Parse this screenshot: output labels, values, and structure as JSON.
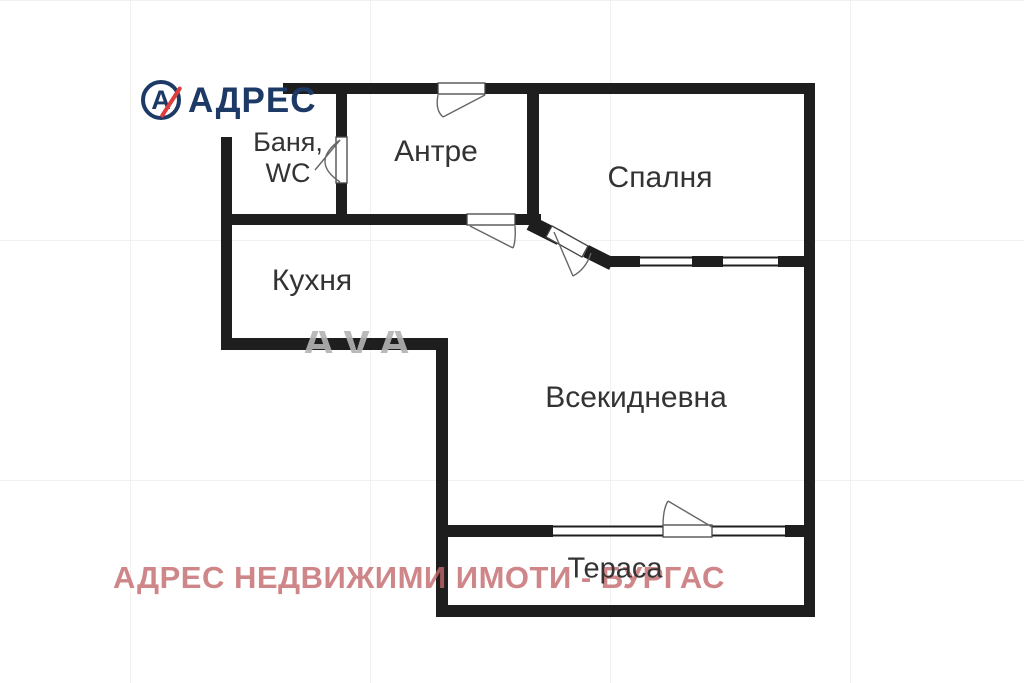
{
  "logo": {
    "brand": "АДРЕС",
    "monogram": "А",
    "navy": "#1d3a66",
    "red": "#e03c3c"
  },
  "watermark": {
    "text": "АДРЕС НЕДВИЖИМИ ИМОТИ - БУРГАС",
    "color": "#c4686c",
    "fragment": "АVА",
    "fragment_color": "#b3b3b3"
  },
  "colors": {
    "wall": "#1e1e1e",
    "door_outline": "#444444",
    "swing_line": "#666666",
    "label_text": "#333333",
    "background": "#ffffff"
  },
  "rooms": [
    {
      "id": "bathroom",
      "label": "Баня,\nWC",
      "cx": 288,
      "cy": 158,
      "font": 27,
      "line_height": 31
    },
    {
      "id": "hall",
      "label": "Антре",
      "cx": 436,
      "cy": 152,
      "font": 30,
      "line_height": 32
    },
    {
      "id": "bedroom",
      "label": "Спалня",
      "cx": 660,
      "cy": 178,
      "font": 30,
      "line_height": 32
    },
    {
      "id": "kitchen",
      "label": "Кухня",
      "cx": 312,
      "cy": 281,
      "font": 30,
      "line_height": 32
    },
    {
      "id": "living",
      "label": "Всекидневна",
      "cx": 636,
      "cy": 398,
      "font": 30,
      "line_height": 32
    },
    {
      "id": "terrace",
      "label": "Тераса",
      "cx": 615,
      "cy": 569,
      "font": 29,
      "line_height": 31
    }
  ],
  "plan": {
    "width": 1024,
    "height": 683,
    "walls": [
      {
        "name": "top-wall-left",
        "x": 283,
        "y": 83,
        "w": 155,
        "h": 11
      },
      {
        "name": "top-wall-right",
        "x": 485,
        "y": 83,
        "w": 330,
        "h": 11
      },
      {
        "name": "right-wall",
        "x": 804,
        "y": 83,
        "w": 11,
        "h": 534
      },
      {
        "name": "left-wall",
        "x": 221,
        "y": 137,
        "w": 11,
        "h": 212
      },
      {
        "name": "bath-divider-upper",
        "x": 336,
        "y": 83,
        "w": 11,
        "h": 54
      },
      {
        "name": "bath-divider-lower",
        "x": 336,
        "y": 183,
        "w": 11,
        "h": 42
      },
      {
        "name": "hall-bottom-left",
        "x": 221,
        "y": 214,
        "w": 246,
        "h": 11
      },
      {
        "name": "hall-bottom-right",
        "x": 515,
        "y": 214,
        "w": 26,
        "h": 11
      },
      {
        "name": "hall-right-wall",
        "x": 527,
        "y": 83,
        "w": 12,
        "h": 139
      },
      {
        "name": "bedroom-bottom-1",
        "x": 605,
        "y": 256,
        "w": 35,
        "h": 11
      },
      {
        "name": "bedroom-bottom-2",
        "x": 692,
        "y": 256,
        "w": 31,
        "h": 11
      },
      {
        "name": "bedroom-bottom-3",
        "x": 778,
        "y": 256,
        "w": 37,
        "h": 11
      },
      {
        "name": "kitchen-bottom",
        "x": 221,
        "y": 338,
        "w": 227,
        "h": 12
      },
      {
        "name": "living-left-wall",
        "x": 436,
        "y": 338,
        "w": 12,
        "h": 279
      },
      {
        "name": "terrace-divider-left",
        "x": 436,
        "y": 525,
        "w": 117,
        "h": 12
      },
      {
        "name": "terrace-divider-right",
        "x": 785,
        "y": 525,
        "w": 30,
        "h": 12
      },
      {
        "name": "terrace-bottom",
        "x": 436,
        "y": 605,
        "w": 379,
        "h": 12
      }
    ],
    "diag_walls": [
      {
        "name": "bedroom-diag-1",
        "x1": 530,
        "y1": 223,
        "x2": 560,
        "y2": 238,
        "w": 15
      },
      {
        "name": "bedroom-diag-2",
        "x1": 586,
        "y1": 251,
        "x2": 612,
        "y2": 264,
        "w": 13
      }
    ],
    "windows": [
      {
        "name": "bedroom-window-1",
        "x": 640,
        "y": 256,
        "w": 52,
        "h": 11
      },
      {
        "name": "bedroom-window-2",
        "x": 723,
        "y": 256,
        "w": 55,
        "h": 11
      },
      {
        "name": "terrace-window-1",
        "x": 553,
        "y": 525,
        "w": 110,
        "h": 12
      },
      {
        "name": "terrace-window-2",
        "x": 712,
        "y": 525,
        "w": 73,
        "h": 12
      }
    ],
    "doors": [
      {
        "name": "entry-door",
        "x": 438,
        "y": 83,
        "w": 47,
        "h": 11
      },
      {
        "name": "bath-door",
        "x": 336,
        "y": 137,
        "w": 11,
        "h": 46
      },
      {
        "name": "hall-door",
        "x": 467,
        "y": 214,
        "w": 48,
        "h": 11
      },
      {
        "name": "terrace-door",
        "x": 663,
        "y": 525,
        "w": 49,
        "h": 12
      }
    ],
    "poly_doors": [
      {
        "name": "bedroom-diag-door",
        "points": "552,226 588,246 582,257 546,237"
      }
    ],
    "fans": [
      {
        "name": "entry-door-swing",
        "d": "M485,95 L443,117 M438,95 Q435,110 443,117"
      },
      {
        "name": "bath-door-swing",
        "d": "M340,140 L315,170 M340,182 Q310,162 340,140"
      },
      {
        "name": "hall-door-swing",
        "d": "M470,226 L513,248 M515,226 Q516,241 513,248"
      },
      {
        "name": "bedroom-door-swing",
        "d": "M554,232 L573,276 M573,276 Q586,269 591,253"
      },
      {
        "name": "terrace-door-swing",
        "d": "M712,527 L668,501 M663,526 Q663,509 668,501"
      }
    ],
    "fragment_clip": {
      "x": 298,
      "y": 331,
      "w": 152,
      "h": 22
    },
    "fragment_pos": {
      "x": 302,
      "y": 357,
      "font": 46
    }
  }
}
